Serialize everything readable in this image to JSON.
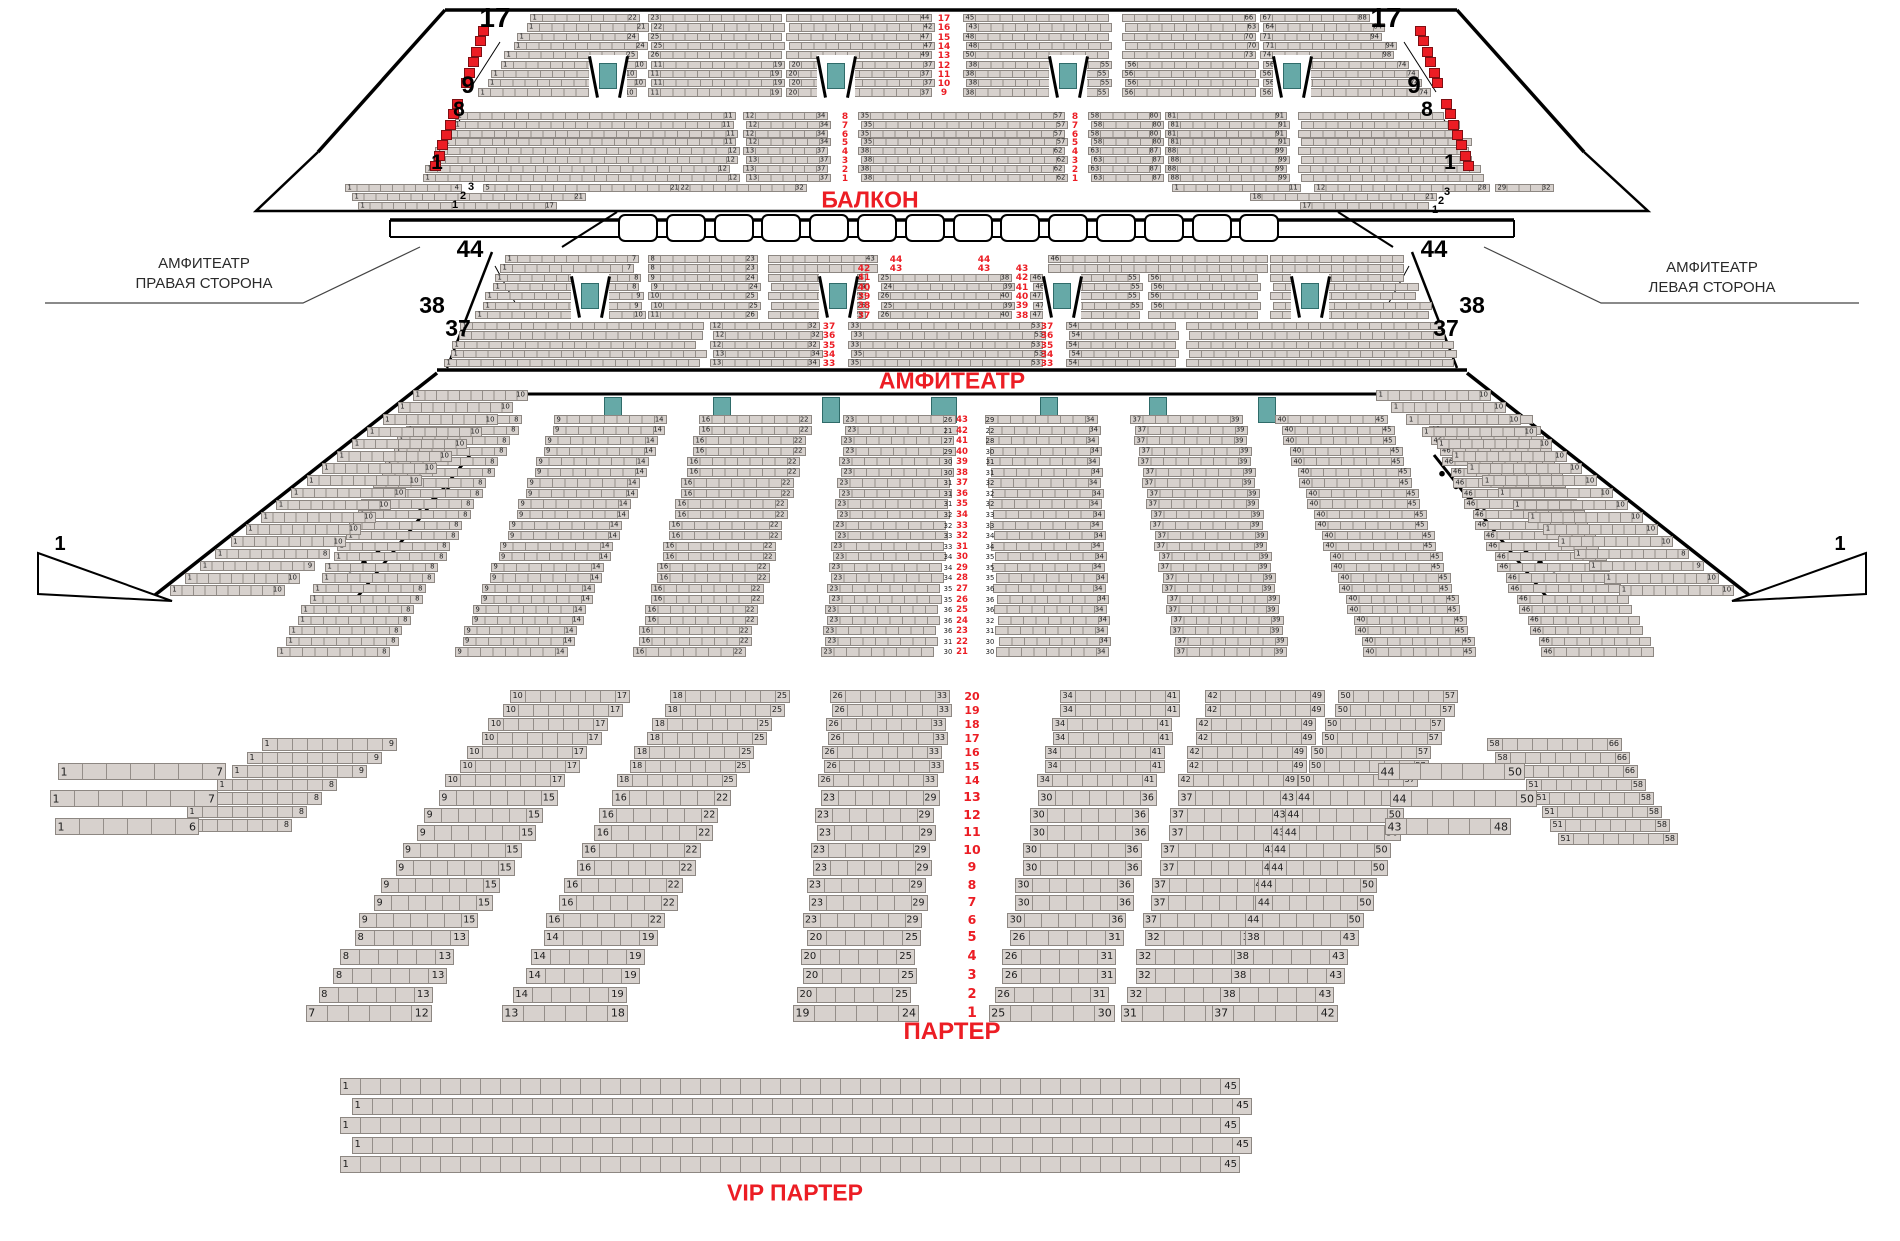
{
  "colors": {
    "seat_fill": "#d7d1cd",
    "seat_border": "#8d8782",
    "red_seat": "#ec1d24",
    "door_teal": "#66a9a7",
    "label_red": "#ec1d24",
    "outline": "#000000"
  },
  "section_labels": {
    "balcony": "БАЛКОН",
    "amphitheater": "АМФИТЕАТР",
    "parterre": "ПАРТЕР",
    "vip": "VIP ПАРТЕР",
    "side_right": [
      "АМФИТЕАТР",
      "ПРАВАЯ СТОРОНА"
    ],
    "side_left": [
      "АМФИТЕАТР",
      "ЛЕВАЯ СТОРОНА"
    ]
  },
  "balcony": {
    "big_left": [
      "17",
      "9",
      "8",
      "1"
    ],
    "big_right": [
      "17",
      "9",
      "8",
      "1"
    ],
    "upper_rows": [
      "17",
      "16",
      "15",
      "14",
      "13",
      "12",
      "11",
      "10",
      "9"
    ],
    "upper_blocks": [
      {
        "s": [
          "1",
          "1",
          "1",
          "1",
          "1",
          "1",
          "1",
          "1",
          "1"
        ],
        "e": [
          "22",
          "21",
          "24",
          "24",
          "25",
          "10",
          "10",
          "10",
          "10"
        ]
      },
      {
        "s": [
          "23",
          "22",
          "25",
          "25",
          "26",
          "11",
          "11",
          "11",
          "11"
        ],
        "e": [
          "",
          "",
          "",
          "",
          "",
          "19",
          "19",
          "19",
          "19"
        ]
      },
      {
        "s": [
          "",
          "",
          "",
          "",
          "",
          "20",
          "20",
          "20",
          "20"
        ],
        "e": [
          "44",
          "42",
          "47",
          "47",
          "49",
          "37",
          "37",
          "37",
          "37"
        ]
      },
      {
        "s": [
          "45",
          "43",
          "48",
          "48",
          "50",
          "38",
          "38",
          "38",
          "38"
        ],
        "e": [
          "",
          "",
          "",
          "",
          "",
          "55",
          "55",
          "55",
          "55"
        ]
      },
      {
        "s": [
          "",
          "",
          "",
          "",
          "",
          "56",
          "56",
          "56",
          "56"
        ],
        "e": [
          "66",
          "63",
          "70",
          "70",
          "73",
          "",
          "",
          "",
          ""
        ]
      },
      {
        "s": [
          "67",
          "64",
          "71",
          "71",
          "74",
          "56",
          "56",
          "56",
          "56"
        ],
        "e": [
          "88",
          "84",
          "94",
          "94",
          "98",
          "74",
          "74",
          "74",
          "74"
        ]
      }
    ],
    "lower_rows": [
      "8",
      "7",
      "6",
      "5",
      "4",
      "3",
      "2",
      "1"
    ],
    "lower_blocks": [
      {
        "s": [
          "1",
          "1",
          "1",
          "1",
          "1",
          "1",
          "1",
          "1"
        ],
        "e": [
          "11",
          "11",
          "11",
          "11",
          "12",
          "12",
          "12",
          "12"
        ]
      },
      {
        "s": [
          "12",
          "12",
          "12",
          "12",
          "13",
          "13",
          "13",
          "13"
        ],
        "e": [
          "34",
          "34",
          "34",
          "34",
          "37",
          "37",
          "37",
          "37"
        ]
      },
      {
        "s": [
          "35",
          "35",
          "35",
          "35",
          "38",
          "38",
          "38",
          "38"
        ],
        "e": [
          "57",
          "57",
          "57",
          "57",
          "62",
          "62",
          "62",
          "62"
        ]
      },
      {
        "s": [
          "58",
          "58",
          "58",
          "58",
          "63",
          "63",
          "63",
          "63"
        ],
        "e": [
          "80",
          "80",
          "80",
          "80",
          "87",
          "87",
          "87",
          "87"
        ]
      },
      {
        "s": [
          "81",
          "81",
          "81",
          "81",
          "88",
          "88",
          "88",
          "88"
        ],
        "e": [
          "91",
          "91",
          "91",
          "91",
          "99",
          "99",
          "99",
          "99"
        ]
      },
      {
        "s": [],
        "e": []
      }
    ],
    "corner_left": {
      "big": [
        "3",
        "2",
        "1"
      ],
      "row1": [
        "1",
        "4",
        "5",
        "21",
        "22",
        "32"
      ],
      "row2": [
        "1",
        "21"
      ],
      "row3": [
        "1",
        "17"
      ]
    },
    "corner_right": {
      "big": [
        "3",
        "2",
        "1"
      ],
      "row1": [
        "1",
        "11",
        "12",
        "28",
        "29",
        "32"
      ],
      "row2": [
        "18",
        "21"
      ],
      "row3": [
        "17",
        ""
      ]
    },
    "box_count": 14
  },
  "amphitheater": {
    "big_left": [
      "44",
      "38",
      "37"
    ],
    "big_right": [
      "44",
      "38",
      "37"
    ],
    "band1_top_red": [
      "44",
      "43"
    ],
    "band1_left_red": [
      "42",
      "41",
      "40",
      "39",
      "38",
      "37"
    ],
    "band1_right_red": [
      "43",
      "42",
      "41",
      "40",
      "39",
      "38"
    ],
    "center_left_end": "43",
    "center_right_start": "46",
    "band1_blocks": [
      {
        "s": [
          "1",
          "1",
          "1",
          "1",
          "1",
          "1",
          "1"
        ],
        "e": [
          "7",
          "7",
          "8",
          "8",
          "9",
          "9",
          "10"
        ]
      },
      {
        "s": [
          "8",
          "8",
          "9",
          "9",
          "10",
          "10",
          "11"
        ],
        "e": [
          "23",
          "23",
          "24",
          "24",
          "25",
          "25",
          "26"
        ]
      },
      {
        "e": [
          "43",
          "24",
          "25",
          "24",
          "25",
          "26",
          "25"
        ]
      },
      {
        "s": [
          "",
          "24",
          "25",
          "24",
          "26",
          "25",
          "26"
        ],
        "e": [
          "",
          "39",
          "38",
          "39",
          "40",
          "39",
          "40"
        ]
      },
      {
        "s": [
          "",
          "46",
          "46",
          "46",
          "47",
          "47",
          "47"
        ],
        "e": [
          "",
          "",
          "55",
          "55",
          "55",
          "55",
          ""
        ]
      },
      {
        "s": [
          "",
          "",
          "56",
          "56",
          "56",
          "56",
          ""
        ]
      },
      {}
    ],
    "band2_rows": [
      "37",
      "36",
      "35",
      "34",
      "33"
    ],
    "band2_blocks": [
      {
        "s": [
          "1",
          "1",
          "1",
          "1",
          "1"
        ]
      },
      {
        "s": [
          "12",
          "12",
          "12",
          "13",
          "13"
        ],
        "e": [
          "32",
          "32",
          "32",
          "34",
          "34"
        ]
      },
      {
        "s": [
          "33",
          "33",
          "33",
          "35",
          "35"
        ],
        "e": [
          "53",
          "53",
          "53",
          "53",
          "53"
        ]
      },
      {
        "s": [
          "54",
          "54",
          "54",
          "54",
          "54"
        ]
      },
      {}
    ]
  },
  "parterre": {
    "upper_rows": [
      "43",
      "42",
      "41",
      "40",
      "39",
      "38",
      "37",
      "36",
      "35",
      "34",
      "33",
      "32",
      "31",
      "30",
      "29",
      "28",
      "27",
      "26",
      "25",
      "24",
      "23",
      "22",
      "21"
    ],
    "upper_cl_col": [
      "26",
      "21",
      "27",
      "29",
      "30",
      "30",
      "31",
      "31",
      "31",
      "32",
      "32",
      "33",
      "33",
      "34",
      "34",
      "34",
      "35",
      "35",
      "36",
      "36",
      "36",
      "31",
      "30"
    ],
    "upper_cr_col": [
      "29",
      "22",
      "28",
      "30",
      "31",
      "31",
      "32",
      "32",
      "32",
      "33",
      "33",
      "34",
      "34",
      "35",
      "35",
      "35",
      "36",
      "36",
      "36",
      "32",
      "31",
      "30",
      "30"
    ],
    "upper_blocks": [
      {
        "s": "1",
        "e": "8"
      },
      {
        "s": "9",
        "e": "14"
      },
      {
        "s": "16",
        "e": "22"
      },
      {
        "s": "23"
      },
      {
        "e": "34"
      },
      {
        "s": "37",
        "e": "39"
      },
      {
        "s": "40",
        "e": "45"
      },
      {
        "s": "46"
      }
    ],
    "lower_rows": [
      "20",
      "19",
      "18",
      "17",
      "16",
      "15",
      "14",
      "13",
      "12",
      "11",
      "10",
      "9",
      "8",
      "7",
      "6",
      "5",
      "4",
      "3",
      "2",
      "1"
    ],
    "lower_blocks": [
      {
        "segs": [
          [
            "10",
            "17"
          ],
          [
            "9",
            "15"
          ],
          [
            "8",
            "13"
          ],
          [
            "7",
            "12"
          ]
        ]
      },
      {
        "segs": [
          [
            "18",
            "25"
          ],
          [
            "16",
            "22"
          ],
          [
            "14",
            "19"
          ],
          [
            "13",
            "18"
          ]
        ]
      },
      {
        "segs": [
          [
            "26",
            "33"
          ],
          [
            "23",
            "29"
          ],
          [
            "20",
            "25"
          ],
          [
            "19",
            "24"
          ]
        ]
      },
      {
        "segs": [
          [
            "34",
            "41"
          ],
          [
            "30",
            "36"
          ],
          [
            "26",
            "31"
          ],
          [
            "25",
            "30"
          ]
        ]
      },
      {
        "segs": [
          [
            "42",
            "49"
          ],
          [
            "37",
            "43"
          ],
          [
            "32",
            "37"
          ],
          [
            "31",
            "36"
          ]
        ]
      },
      {
        "segs": [
          [
            "50",
            "57"
          ],
          [
            "44",
            "50"
          ],
          [
            "38",
            "43"
          ],
          [
            "37",
            "42"
          ]
        ]
      }
    ],
    "outer_left": {
      "diag": [
        [
          "1",
          "9"
        ],
        [
          "1",
          "9"
        ],
        [
          "1",
          "9"
        ],
        [
          "1",
          "8"
        ],
        [
          "1",
          "8"
        ],
        [
          "1",
          "8"
        ],
        [
          "1",
          "8"
        ]
      ],
      "front": [
        [
          "1",
          "7"
        ],
        [
          "1",
          "7"
        ],
        [
          "1",
          "6"
        ]
      ]
    },
    "outer_right": {
      "diag": [
        [
          "58",
          "66"
        ],
        [
          "58",
          "66"
        ],
        [
          "58",
          "66"
        ],
        [
          "51",
          "58"
        ],
        [
          "51",
          "58"
        ],
        [
          "51",
          "58"
        ],
        [
          "51",
          "58"
        ],
        [
          "51",
          "58"
        ]
      ],
      "front": [
        [
          "44",
          "50"
        ],
        [
          "44",
          "50"
        ],
        [
          "43",
          "48"
        ]
      ]
    }
  },
  "wings": {
    "left": {
      "big": "1",
      "row_start": "1",
      "row_ends": [
        "10",
        "10",
        "10",
        "10",
        "10",
        "10",
        "10",
        "10",
        "10",
        "10",
        "10",
        "10",
        "10",
        "8",
        "9",
        "10",
        "10"
      ]
    },
    "right": {
      "big": "1",
      "row_start": "1",
      "row_ends": [
        "10",
        "10",
        "10",
        "10",
        "10",
        "10",
        "10",
        "10",
        "10",
        "10",
        "10",
        "10",
        "10",
        "8",
        "9",
        "10",
        "10"
      ]
    }
  },
  "vip": {
    "rows": [
      {
        "s": "1",
        "e": "45"
      },
      {
        "s": "1",
        "e": "45"
      },
      {
        "s": "1",
        "e": "45"
      },
      {
        "s": "1",
        "e": "45"
      },
      {
        "s": "1",
        "e": "45"
      }
    ]
  }
}
